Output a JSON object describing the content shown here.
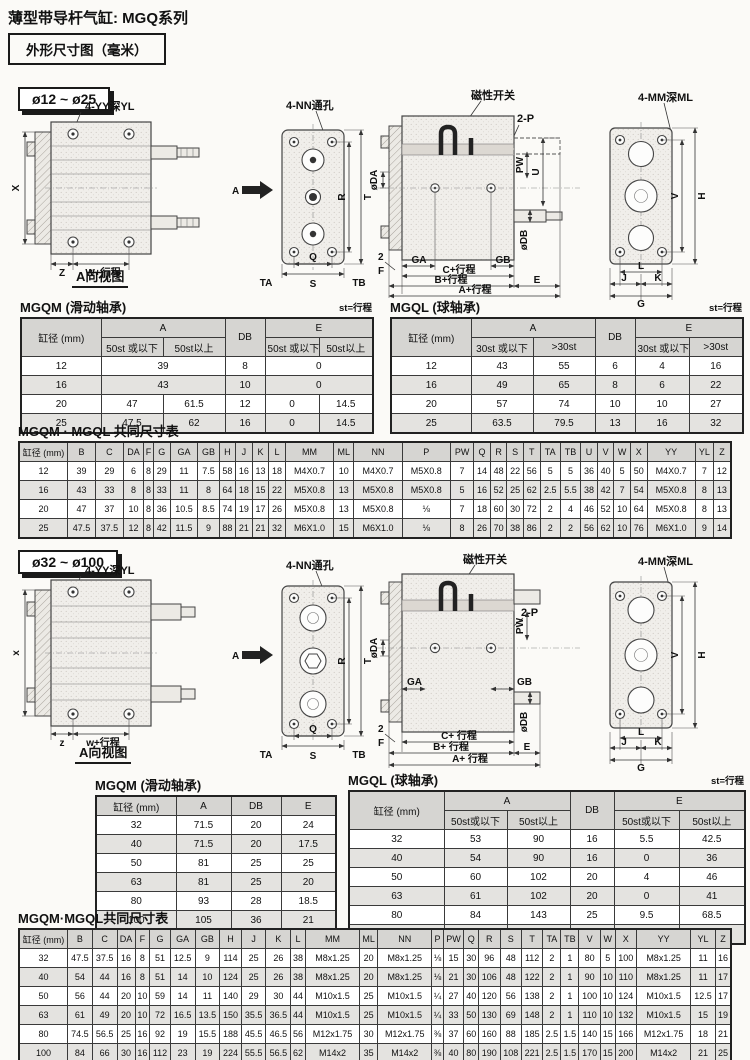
{
  "page": {
    "title": "薄型带导杆气缸: MGQ系列",
    "dim_box": "外形尺寸图（毫米）"
  },
  "s1": {
    "badge": "ø12 ~ ø25",
    "d": {
      "yy": "4-YY深YL",
      "nn": "4-NN通孔",
      "mag": "磁性开关",
      "p2": "2-P",
      "mm": "4-MM深ML",
      "viewA": "A向视图",
      "A": "A",
      "X": "X",
      "Z": "Z",
      "W": "W+行程",
      "Q": "Q",
      "S": "S",
      "TA": "TA",
      "TB": "TB",
      "R": "R",
      "T": "T",
      "DA": "øDA",
      "DB": "øDB",
      "PW": "PW",
      "U": "U",
      "V": "V",
      "H": "H",
      "two": "2",
      "F": "F",
      "GA": "GA",
      "GB": "GB",
      "Cst": "C+行程",
      "Bst": "B+行程",
      "Ast": "A+行程",
      "E": "E",
      "L": "L",
      "K": "K",
      "J": "J",
      "G": "G"
    },
    "mgqm": {
      "title": "MGQM (滑动轴承)",
      "note": "st=行程",
      "rows": [
        {
          "h": 1,
          "cells": [
            {
              "t": "缸径 (mm)",
              "rs": 2
            },
            {
              "t": "A",
              "cs": 2
            },
            {
              "t": "DB",
              "rs": 2
            },
            {
              "t": "E",
              "cs": 2
            }
          ]
        },
        {
          "h": 1,
          "cells": [
            "50st 或以下",
            "50st以上",
            "50st 或以下",
            "50st以上"
          ]
        },
        {
          "cells": [
            "12",
            {
              "t": "39",
              "cs": 2
            },
            "8",
            {
              "t": "0",
              "cs": 2
            }
          ]
        },
        {
          "cells": [
            "16",
            {
              "t": "43",
              "cs": 2
            },
            "10",
            {
              "t": "0",
              "cs": 2
            }
          ]
        },
        {
          "cells": [
            "20",
            "47",
            "61.5",
            "12",
            "0",
            "14.5"
          ]
        },
        {
          "cells": [
            "25",
            "47.5",
            "62",
            "16",
            "0",
            "14.5"
          ]
        }
      ]
    },
    "mgql": {
      "title": "MGQL (球轴承)",
      "note": "st=行程",
      "rows": [
        {
          "h": 1,
          "cells": [
            {
              "t": "缸径 (mm)",
              "rs": 2
            },
            {
              "t": "A",
              "cs": 2
            },
            {
              "t": "DB",
              "rs": 2
            },
            {
              "t": "E",
              "cs": 2
            }
          ]
        },
        {
          "h": 1,
          "cells": [
            "30st 或以下",
            ">30st",
            "30st 或以下",
            ">30st"
          ]
        },
        {
          "cells": [
            "12",
            "43",
            "55",
            "6",
            "4",
            "16"
          ]
        },
        {
          "cells": [
            "16",
            "49",
            "65",
            "8",
            "6",
            "22"
          ]
        },
        {
          "cells": [
            "20",
            "57",
            "74",
            "10",
            "10",
            "27"
          ]
        },
        {
          "cells": [
            "25",
            "63.5",
            "79.5",
            "13",
            "16",
            "32"
          ]
        }
      ]
    },
    "common": {
      "title": "MGQM · MGQL 共同尺寸表",
      "rows": [
        {
          "h": 1,
          "cells": [
            "缸径 (mm)",
            "B",
            "C",
            "DA",
            "F",
            "G",
            "GA",
            "GB",
            "H",
            "J",
            "K",
            "L",
            "MM",
            "ML",
            "NN",
            "P",
            "PW",
            "Q",
            "R",
            "S",
            "T",
            "TA",
            "TB",
            "U",
            "V",
            "W",
            "X",
            "YY",
            "YL",
            "Z"
          ]
        },
        {
          "cells": [
            "12",
            "39",
            "29",
            "6",
            "8",
            "29",
            "11",
            "7.5",
            "58",
            "16",
            "13",
            "18",
            "M4X0.7",
            "10",
            "M4X0.7",
            "M5X0.8",
            "7",
            "14",
            "48",
            "22",
            "56",
            "5",
            "5",
            "36",
            "40",
            "5",
            "50",
            "M4X0.7",
            "7",
            "12"
          ]
        },
        {
          "cells": [
            "16",
            "43",
            "33",
            "8",
            "8",
            "33",
            "11",
            "8",
            "64",
            "18",
            "15",
            "22",
            "M5X0.8",
            "13",
            "M5X0.8",
            "M5X0.8",
            "5",
            "16",
            "52",
            "25",
            "62",
            "2.5",
            "5.5",
            "38",
            "42",
            "7",
            "54",
            "M5X0.8",
            "8",
            "13"
          ]
        },
        {
          "cells": [
            "20",
            "47",
            "37",
            "10",
            "8",
            "36",
            "10.5",
            "8.5",
            "74",
            "19",
            "17",
            "26",
            "M5X0.8",
            "13",
            "M5X0.8",
            "⅛",
            "7",
            "18",
            "60",
            "30",
            "72",
            "2",
            "4",
            "46",
            "52",
            "10",
            "64",
            "M5X0.8",
            "8",
            "13"
          ]
        },
        {
          "cells": [
            "25",
            "47.5",
            "37.5",
            "12",
            "8",
            "42",
            "11.5",
            "9",
            "88",
            "21",
            "21",
            "32",
            "M6X1.0",
            "15",
            "M6X1.0",
            "⅛",
            "8",
            "26",
            "70",
            "38",
            "86",
            "2",
            "2",
            "56",
            "62",
            "10",
            "76",
            "M6X1.0",
            "9",
            "14"
          ]
        }
      ]
    }
  },
  "s2": {
    "badge": "ø32 ~ ø100",
    "d": {
      "yy": "4-YY深YL",
      "nn": "4-NN通孔",
      "mag": "磁性开关",
      "p2": "2-P",
      "mm": "4-MM深ML",
      "viewA": "A向视图",
      "A": "A",
      "X": "x",
      "Z": "z",
      "W": "w+行程",
      "Q": "Q",
      "S": "S",
      "TA": "TA",
      "TB": "TB",
      "R": "R",
      "T": "T",
      "DA": "øDA",
      "DB": "øDB",
      "PW": "PW",
      "V": "V",
      "H": "H",
      "two": "2",
      "F": "F",
      "GA": "GA",
      "GB": "GB",
      "Cst": "C+ 行程",
      "Bst": "B+ 行程",
      "Ast": "A+ 行程",
      "E": "E",
      "L": "L",
      "K": "K",
      "J": "J",
      "G": "G"
    },
    "mgqm": {
      "title": "MGQM (滑动轴承)",
      "rows": [
        {
          "h": 1,
          "cells": [
            "缸径 (mm)",
            "A",
            "DB",
            "E"
          ]
        },
        {
          "cells": [
            "32",
            "71.5",
            "20",
            "24"
          ]
        },
        {
          "cells": [
            "40",
            "71.5",
            "20",
            "17.5"
          ]
        },
        {
          "cells": [
            "50",
            "81",
            "25",
            "25"
          ]
        },
        {
          "cells": [
            "63",
            "81",
            "25",
            "20"
          ]
        },
        {
          "cells": [
            "80",
            "93",
            "28",
            "18.5"
          ]
        },
        {
          "cells": [
            "100",
            "105",
            "36",
            "21"
          ]
        }
      ]
    },
    "mgql": {
      "title": "MGQL (球轴承)",
      "note": "st=行程",
      "rows": [
        {
          "h": 1,
          "cells": [
            {
              "t": "缸径 (mm)",
              "rs": 2
            },
            {
              "t": "A",
              "cs": 2
            },
            {
              "t": "DB",
              "rs": 2
            },
            {
              "t": "E",
              "cs": 2
            }
          ]
        },
        {
          "h": 1,
          "cells": [
            "50st或以下",
            "50st以上",
            "50st或以下",
            "50st以上"
          ]
        },
        {
          "cells": [
            "32",
            "53",
            "90",
            "16",
            "5.5",
            "42.5"
          ]
        },
        {
          "cells": [
            "40",
            "54",
            "90",
            "16",
            "0",
            "36"
          ]
        },
        {
          "cells": [
            "50",
            "60",
            "102",
            "20",
            "4",
            "46"
          ]
        },
        {
          "cells": [
            "63",
            "61",
            "102",
            "20",
            "0",
            "41"
          ]
        },
        {
          "cells": [
            "80",
            "84",
            "143",
            "25",
            "9.5",
            "68.5"
          ]
        },
        {
          "cells": [
            "100",
            "89",
            "153",
            "30",
            "5",
            "69"
          ]
        }
      ]
    },
    "common": {
      "title": "MGQM·MGQL共同尺寸表",
      "rows": [
        {
          "h": 1,
          "cells": [
            "缸径 (mm)",
            "B",
            "C",
            "DA",
            "F",
            "G",
            "GA",
            "GB",
            "H",
            "J",
            "K",
            "L",
            "MM",
            "ML",
            "NN",
            "P",
            "PW",
            "Q",
            "R",
            "S",
            "T",
            "TA",
            "TB",
            "V",
            "W",
            "X",
            "YY",
            "YL",
            "Z"
          ]
        },
        {
          "cells": [
            "32",
            "47.5",
            "37.5",
            "16",
            "8",
            "51",
            "12.5",
            "9",
            "114",
            "25",
            "26",
            "38",
            "M8x1.25",
            "20",
            "M8x1.25",
            "⅛",
            "15",
            "30",
            "96",
            "48",
            "112",
            "2",
            "1",
            "80",
            "5",
            "100",
            "M8x1.25",
            "11",
            "16"
          ]
        },
        {
          "cells": [
            "40",
            "54",
            "44",
            "16",
            "8",
            "51",
            "14",
            "10",
            "124",
            "25",
            "26",
            "38",
            "M8x1.25",
            "20",
            "M8x1.25",
            "⅛",
            "21",
            "30",
            "106",
            "48",
            "122",
            "2",
            "1",
            "90",
            "10",
            "110",
            "M8x1.25",
            "11",
            "17"
          ]
        },
        {
          "cells": [
            "50",
            "56",
            "44",
            "20",
            "10",
            "59",
            "14",
            "11",
            "140",
            "29",
            "30",
            "44",
            "M10x1.5",
            "25",
            "M10x1.5",
            "¼",
            "27",
            "40",
            "120",
            "56",
            "138",
            "2",
            "1",
            "100",
            "10",
            "124",
            "M10x1.5",
            "12.5",
            "17"
          ]
        },
        {
          "cells": [
            "63",
            "61",
            "49",
            "20",
            "10",
            "72",
            "16.5",
            "13.5",
            "150",
            "35.5",
            "36.5",
            "44",
            "M10x1.5",
            "25",
            "M10x1.5",
            "¼",
            "33",
            "50",
            "130",
            "69",
            "148",
            "2",
            "1",
            "110",
            "10",
            "132",
            "M10x1.5",
            "15",
            "19"
          ]
        },
        {
          "cells": [
            "80",
            "74.5",
            "56.5",
            "25",
            "16",
            "92",
            "19",
            "15.5",
            "188",
            "45.5",
            "46.5",
            "56",
            "M12x1.75",
            "30",
            "M12x1.75",
            "⅜",
            "37",
            "60",
            "160",
            "88",
            "185",
            "2.5",
            "1.5",
            "140",
            "15",
            "166",
            "M12x1.75",
            "18",
            "21"
          ]
        },
        {
          "cells": [
            "100",
            "84",
            "66",
            "30",
            "16",
            "112",
            "23",
            "19",
            "224",
            "55.5",
            "56.5",
            "62",
            "M14x2",
            "35",
            "M14x2",
            "⅜",
            "40",
            "80",
            "190",
            "108",
            "221",
            "2.5",
            "1.5",
            "170",
            "15",
            "200",
            "M14x2",
            "21",
            "25"
          ]
        }
      ]
    }
  }
}
